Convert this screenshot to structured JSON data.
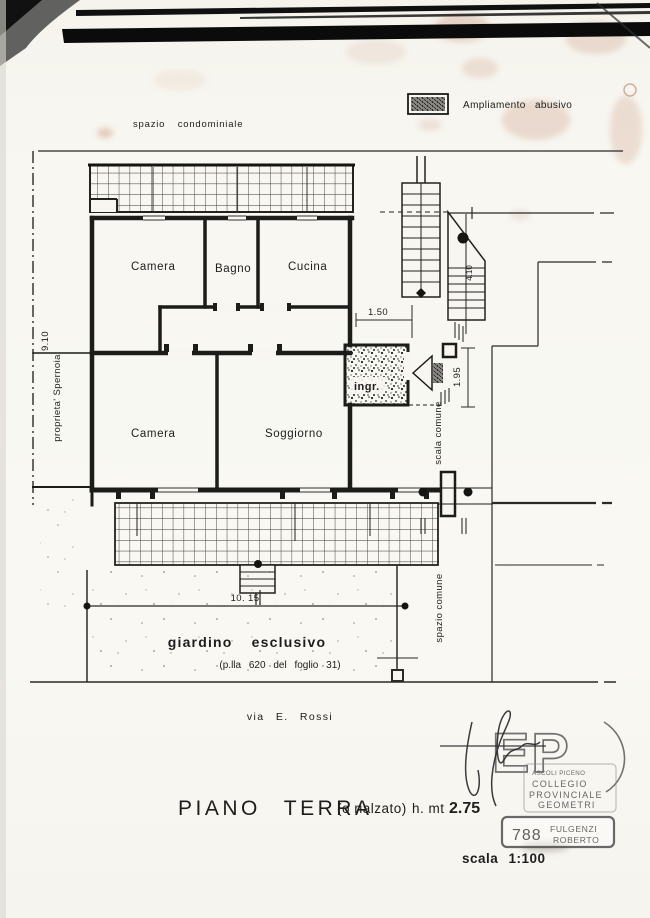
{
  "page": {
    "title_main": "PIANO TERRA",
    "title_paren": "(o rialzato)",
    "title_height_label": "h. mt",
    "title_height_value": "2.75",
    "scale_label": "scala 1:100",
    "street_label": "via E. Rossi"
  },
  "legend": {
    "label": "Ampliamento abusivo"
  },
  "areas": {
    "condo_space": "spazio condominiale",
    "property_line": "proprieta'  Spernoia",
    "garden_title": "giardino esclusivo",
    "garden_sub": "(p.lla 620 del foglio 31)",
    "common_space": "spazio comune",
    "common_stairs": "scala comune"
  },
  "rooms": {
    "camera1": "Camera",
    "bagno": "Bagno",
    "cucina": "Cucina",
    "camera2": "Camera",
    "soggiorno": "Soggiorno",
    "ingresso": "ingr."
  },
  "dimensions": {
    "left_height": "9.10",
    "entry_width": "1.50",
    "stair_width": "1.95",
    "stair_length": "4.10",
    "garden_width": "10. 15"
  },
  "stamp": {
    "monogram": "EP",
    "org_city": "ASCOLI PICENO",
    "org_line1": "COLLEGIO",
    "org_line2": "PROVINCIALE",
    "org_line3": "GEOMETRI",
    "number": "788",
    "surname": "FULGENZI",
    "name": "ROBERTO"
  },
  "colors": {
    "ink": "#1d1d1b",
    "paper": "#f8f6f1",
    "stain": "#c3876b",
    "scan_bar": "#0b0b0b"
  }
}
